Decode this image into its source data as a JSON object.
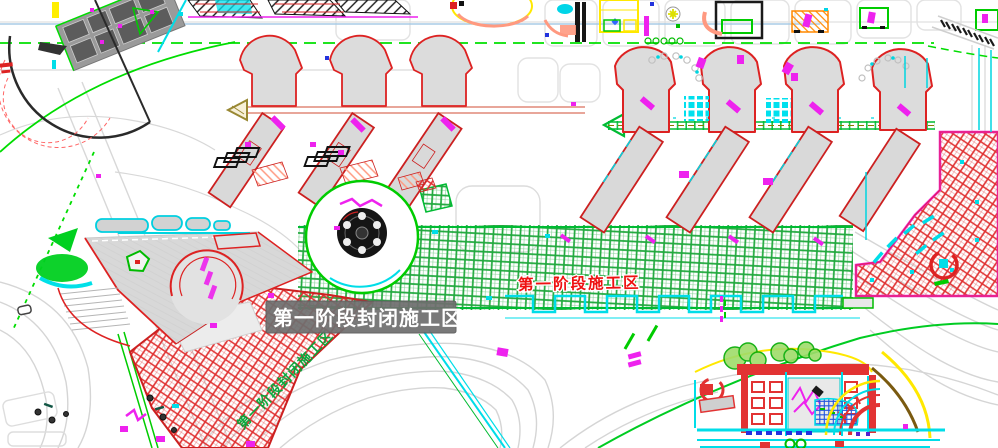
{
  "app": {
    "type": "cad-construction-site-plan"
  },
  "canvas": {
    "width": 998,
    "height": 448,
    "background": "#ffffff"
  },
  "labels": {
    "closed_zone": {
      "text": "第一阶段封闭施工区",
      "text_color": "#ffffff",
      "box_color": "#707070"
    },
    "phase_zone": {
      "text": "第一阶段施工区",
      "color": "#ee1111"
    },
    "band_text": {
      "text": "第一阶段封闭施工区",
      "color": "#00a838"
    }
  },
  "legend_colors": {
    "closed_area_hatch_red": "#e03030",
    "phase1_area_hatch_green": "#21a93e",
    "zone_border_magenta": "#ee22ee",
    "road_gray": "#d8d8d8",
    "boundary_green": "#00dd00",
    "building_outline_red": "#dd2222",
    "accent_cyan": "#00dde8",
    "accent_yellow": "#ffe800",
    "accent_blue": "#2233dd",
    "accent_salmon": "#ff9980",
    "accent_orange": "#ff8800",
    "building_fill_gray": "#dcdcdc"
  }
}
